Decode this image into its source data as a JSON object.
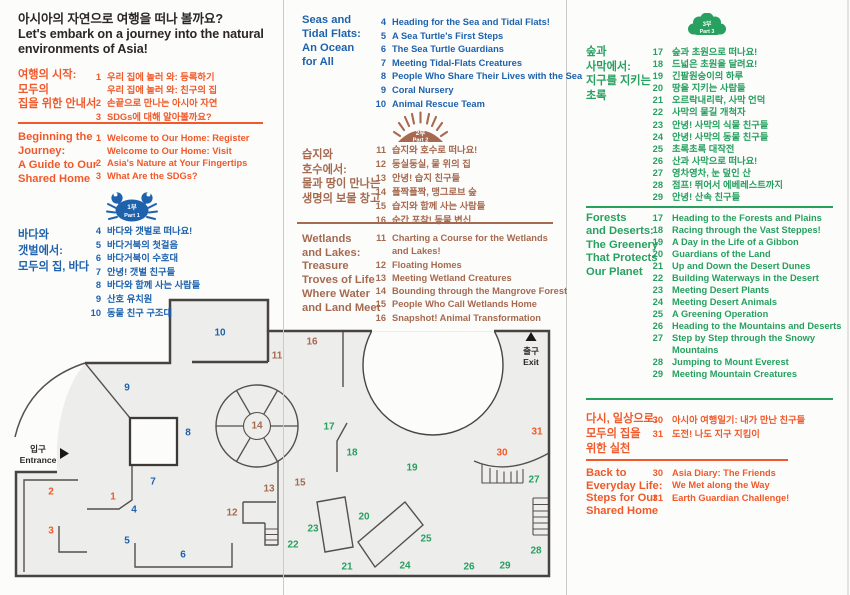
{
  "colors": {
    "orange": "#F1592A",
    "blue": "#1E62AD",
    "brown": "#A66A50",
    "green": "#27A060",
    "dark": "#2B2724",
    "wall": "#4A4541",
    "floor": "#EDEDEB",
    "fold": "#CBCAC8"
  },
  "title": {
    "kr": "아시아의 자연으로 여행을 떠나 볼까요?",
    "en1": "Let's embark on a journey into the natural",
    "en2": "environments of Asia!"
  },
  "icons": {
    "part1": {
      "kr": "1부",
      "en": "Part 1"
    },
    "part2": {
      "kr": "2부",
      "en": "Part 2"
    },
    "part3": {
      "kr": "3부",
      "en": "Part 3"
    }
  },
  "sections": {
    "intro_kr": {
      "heading": [
        "여행의 시작:",
        "모두의",
        "집을 위한 안내서"
      ],
      "items": [
        {
          "n": "1",
          "t": "우리 집에 놀러 와: 등록하기"
        },
        {
          "n": "",
          "t": "우리 집에 놀러 와: 친구의 집"
        },
        {
          "n": "2",
          "t": "손끝으로 만나는 아시아 자연"
        },
        {
          "n": "3",
          "t": "SDGs에 대해 알아볼까요?"
        }
      ]
    },
    "intro_en": {
      "heading": [
        "Beginning the",
        "Journey:",
        "A Guide to Our",
        "Shared Home"
      ],
      "items": [
        {
          "n": "1",
          "t": "Welcome to Our Home: Register"
        },
        {
          "n": "",
          "t": "Welcome to Our Home: Visit"
        },
        {
          "n": "2",
          "t": "Asia's Nature at Your Fingertips"
        },
        {
          "n": "3",
          "t": "What Are the SDGs?"
        }
      ]
    },
    "part1_kr": {
      "heading": [
        "바다와",
        "갯벌에서:",
        "모두의 집, 바다"
      ],
      "items": [
        {
          "n": "4",
          "t": "바다와 갯벌로 떠나요!"
        },
        {
          "n": "5",
          "t": "바다거북의 첫걸음"
        },
        {
          "n": "6",
          "t": "바다거북이 수호대"
        },
        {
          "n": "7",
          "t": "안녕! 갯벌 친구들"
        },
        {
          "n": "8",
          "t": "바다와 함께 사는 사람들"
        },
        {
          "n": "9",
          "t": "산호 유치원"
        },
        {
          "n": "10",
          "t": "동물 친구 구조대"
        }
      ]
    },
    "part1_en": {
      "heading": [
        "Seas and",
        "Tidal Flats:",
        "An Ocean",
        "for All"
      ],
      "items": [
        {
          "n": "4",
          "t": "Heading for the Sea and Tidal Flats!"
        },
        {
          "n": "5",
          "t": "A Sea Turtle's First Steps"
        },
        {
          "n": "6",
          "t": "The Sea Turtle Guardians"
        },
        {
          "n": "7",
          "t": "Meeting Tidal-Flats Creatures"
        },
        {
          "n": "8",
          "t": "People Who Share Their Lives with the Sea"
        },
        {
          "n": "9",
          "t": "Coral Nursery"
        },
        {
          "n": "10",
          "t": "Animal Rescue Team"
        }
      ]
    },
    "part2_kr": {
      "heading": [
        "습지와",
        "호수에서:",
        "물과 땅이 만나는",
        "생명의 보물 창고"
      ],
      "items": [
        {
          "n": "11",
          "t": "습지와 호수로 떠나요!"
        },
        {
          "n": "12",
          "t": "둥실둥실, 물 위의 집"
        },
        {
          "n": "13",
          "t": "안녕! 습지 친구들"
        },
        {
          "n": "14",
          "t": "폴짝폴짝, 맹그로브 숲"
        },
        {
          "n": "15",
          "t": "습지와 함께 사는 사람들"
        },
        {
          "n": "16",
          "t": "순간 포착! 동물 변신"
        }
      ]
    },
    "part2_en": {
      "heading": [
        "Wetlands",
        "and Lakes:",
        "Treasure",
        "Troves of Life",
        "Where Water",
        "and Land Meet"
      ],
      "items": [
        {
          "n": "11",
          "t": "Charting a Course for the Wetlands"
        },
        {
          "n": "",
          "t": "and Lakes!"
        },
        {
          "n": "12",
          "t": "Floating Homes"
        },
        {
          "n": "13",
          "t": "Meeting Wetland Creatures"
        },
        {
          "n": "14",
          "t": "Bounding through the Mangrove Forest"
        },
        {
          "n": "15",
          "t": "People Who Call Wetlands Home"
        },
        {
          "n": "16",
          "t": "Snapshot! Animal Transformation"
        }
      ]
    },
    "part3_kr": {
      "heading": [
        "숲과",
        "사막에서:",
        "지구를 지키는",
        "초록"
      ],
      "items": [
        {
          "n": "17",
          "t": "숲과 초원으로 떠나요!"
        },
        {
          "n": "18",
          "t": "드넓은 초원을 달려요!"
        },
        {
          "n": "19",
          "t": "긴팔원숭이의 하루"
        },
        {
          "n": "20",
          "t": "땅을 지키는 사람들"
        },
        {
          "n": "21",
          "t": "오르락내리락, 사막 언덕"
        },
        {
          "n": "22",
          "t": "사막의 물길 개척자"
        },
        {
          "n": "23",
          "t": "안녕! 사막의 식물 친구들"
        },
        {
          "n": "24",
          "t": "안녕! 사막의 동물 친구들"
        },
        {
          "n": "25",
          "t": "초록초록 대작전"
        },
        {
          "n": "26",
          "t": "산과 사막으로 떠나요!"
        },
        {
          "n": "27",
          "t": "영차영차, 눈 덮인 산"
        },
        {
          "n": "28",
          "t": "점프! 뛰어서 에베레스트까지"
        },
        {
          "n": "29",
          "t": "안녕! 산속 친구들"
        }
      ]
    },
    "part3_en": {
      "heading": [
        "Forests",
        "and Deserts:",
        "The Greenery",
        "That Protects",
        "Our Planet"
      ],
      "items": [
        {
          "n": "17",
          "t": "Heading to the Forests and Plains"
        },
        {
          "n": "18",
          "t": "Racing through the Vast Steppes!"
        },
        {
          "n": "19",
          "t": "A Day in the Life of a Gibbon"
        },
        {
          "n": "20",
          "t": "Guardians of the Land"
        },
        {
          "n": "21",
          "t": "Up and Down the Desert Dunes"
        },
        {
          "n": "22",
          "t": "Building Waterways in the Desert"
        },
        {
          "n": "23",
          "t": "Meeting Desert Plants"
        },
        {
          "n": "24",
          "t": "Meeting Desert Animals"
        },
        {
          "n": "25",
          "t": "A Greening Operation"
        },
        {
          "n": "26",
          "t": "Heading to the Mountains and Deserts"
        },
        {
          "n": "27",
          "t": "Step by Step through the Snowy"
        },
        {
          "n": "",
          "t": "Mountains"
        },
        {
          "n": "28",
          "t": "Jumping to Mount Everest"
        },
        {
          "n": "29",
          "t": "Meeting Mountain Creatures"
        }
      ]
    },
    "outro_kr": {
      "heading": [
        "다시, 일상으로:",
        "모두의 집을",
        "위한 실천"
      ],
      "items": [
        {
          "n": "30",
          "t": "아시아 여행일기: 내가 만난 친구들"
        },
        {
          "n": "31",
          "t": "도전! 나도 지구 지킴이"
        }
      ]
    },
    "outro_en": {
      "heading": [
        "Back to",
        "Everyday Life:",
        "Steps for Our",
        "Shared Home"
      ],
      "items": [
        {
          "n": "30",
          "t": "Asia Diary: The Friends"
        },
        {
          "n": "",
          "t": "We Met along the Way"
        },
        {
          "n": "31",
          "t": "Earth Guardian Challenge!"
        }
      ]
    }
  },
  "map": {
    "entrance_kr": "입구",
    "entrance_en": "Entrance",
    "exit_kr": "출구",
    "exit_en": "Exit",
    "markers": [
      {
        "n": "1",
        "x": 113,
        "y": 497,
        "c": "orange"
      },
      {
        "n": "2",
        "x": 51,
        "y": 492,
        "c": "orange"
      },
      {
        "n": "3",
        "x": 51,
        "y": 531,
        "c": "orange"
      },
      {
        "n": "4",
        "x": 134,
        "y": 510,
        "c": "blue"
      },
      {
        "n": "5",
        "x": 127,
        "y": 541,
        "c": "blue"
      },
      {
        "n": "6",
        "x": 183,
        "y": 555,
        "c": "blue"
      },
      {
        "n": "7",
        "x": 153,
        "y": 482,
        "c": "blue"
      },
      {
        "n": "8",
        "x": 188,
        "y": 433,
        "c": "blue"
      },
      {
        "n": "9",
        "x": 127,
        "y": 388,
        "c": "blue"
      },
      {
        "n": "10",
        "x": 220,
        "y": 333,
        "c": "blue"
      },
      {
        "n": "11",
        "x": 277,
        "y": 356,
        "c": "brown"
      },
      {
        "n": "12",
        "x": 232,
        "y": 513,
        "c": "brown"
      },
      {
        "n": "13",
        "x": 269,
        "y": 489,
        "c": "brown"
      },
      {
        "n": "14",
        "x": 257,
        "y": 426,
        "c": "brown"
      },
      {
        "n": "15",
        "x": 300,
        "y": 483,
        "c": "brown"
      },
      {
        "n": "16",
        "x": 312,
        "y": 342,
        "c": "brown"
      },
      {
        "n": "17",
        "x": 329,
        "y": 427,
        "c": "green"
      },
      {
        "n": "18",
        "x": 352,
        "y": 453,
        "c": "green"
      },
      {
        "n": "19",
        "x": 412,
        "y": 468,
        "c": "green"
      },
      {
        "n": "20",
        "x": 364,
        "y": 517,
        "c": "green"
      },
      {
        "n": "21",
        "x": 347,
        "y": 567,
        "c": "green"
      },
      {
        "n": "22",
        "x": 293,
        "y": 545,
        "c": "green"
      },
      {
        "n": "23",
        "x": 313,
        "y": 529,
        "c": "green"
      },
      {
        "n": "24",
        "x": 405,
        "y": 566,
        "c": "green"
      },
      {
        "n": "25",
        "x": 426,
        "y": 539,
        "c": "green"
      },
      {
        "n": "26",
        "x": 469,
        "y": 567,
        "c": "green"
      },
      {
        "n": "27",
        "x": 534,
        "y": 480,
        "c": "green"
      },
      {
        "n": "28",
        "x": 536,
        "y": 551,
        "c": "green"
      },
      {
        "n": "29",
        "x": 505,
        "y": 566,
        "c": "green"
      },
      {
        "n": "30",
        "x": 502,
        "y": 453,
        "c": "orange"
      },
      {
        "n": "31",
        "x": 537,
        "y": 432,
        "c": "orange"
      }
    ]
  }
}
